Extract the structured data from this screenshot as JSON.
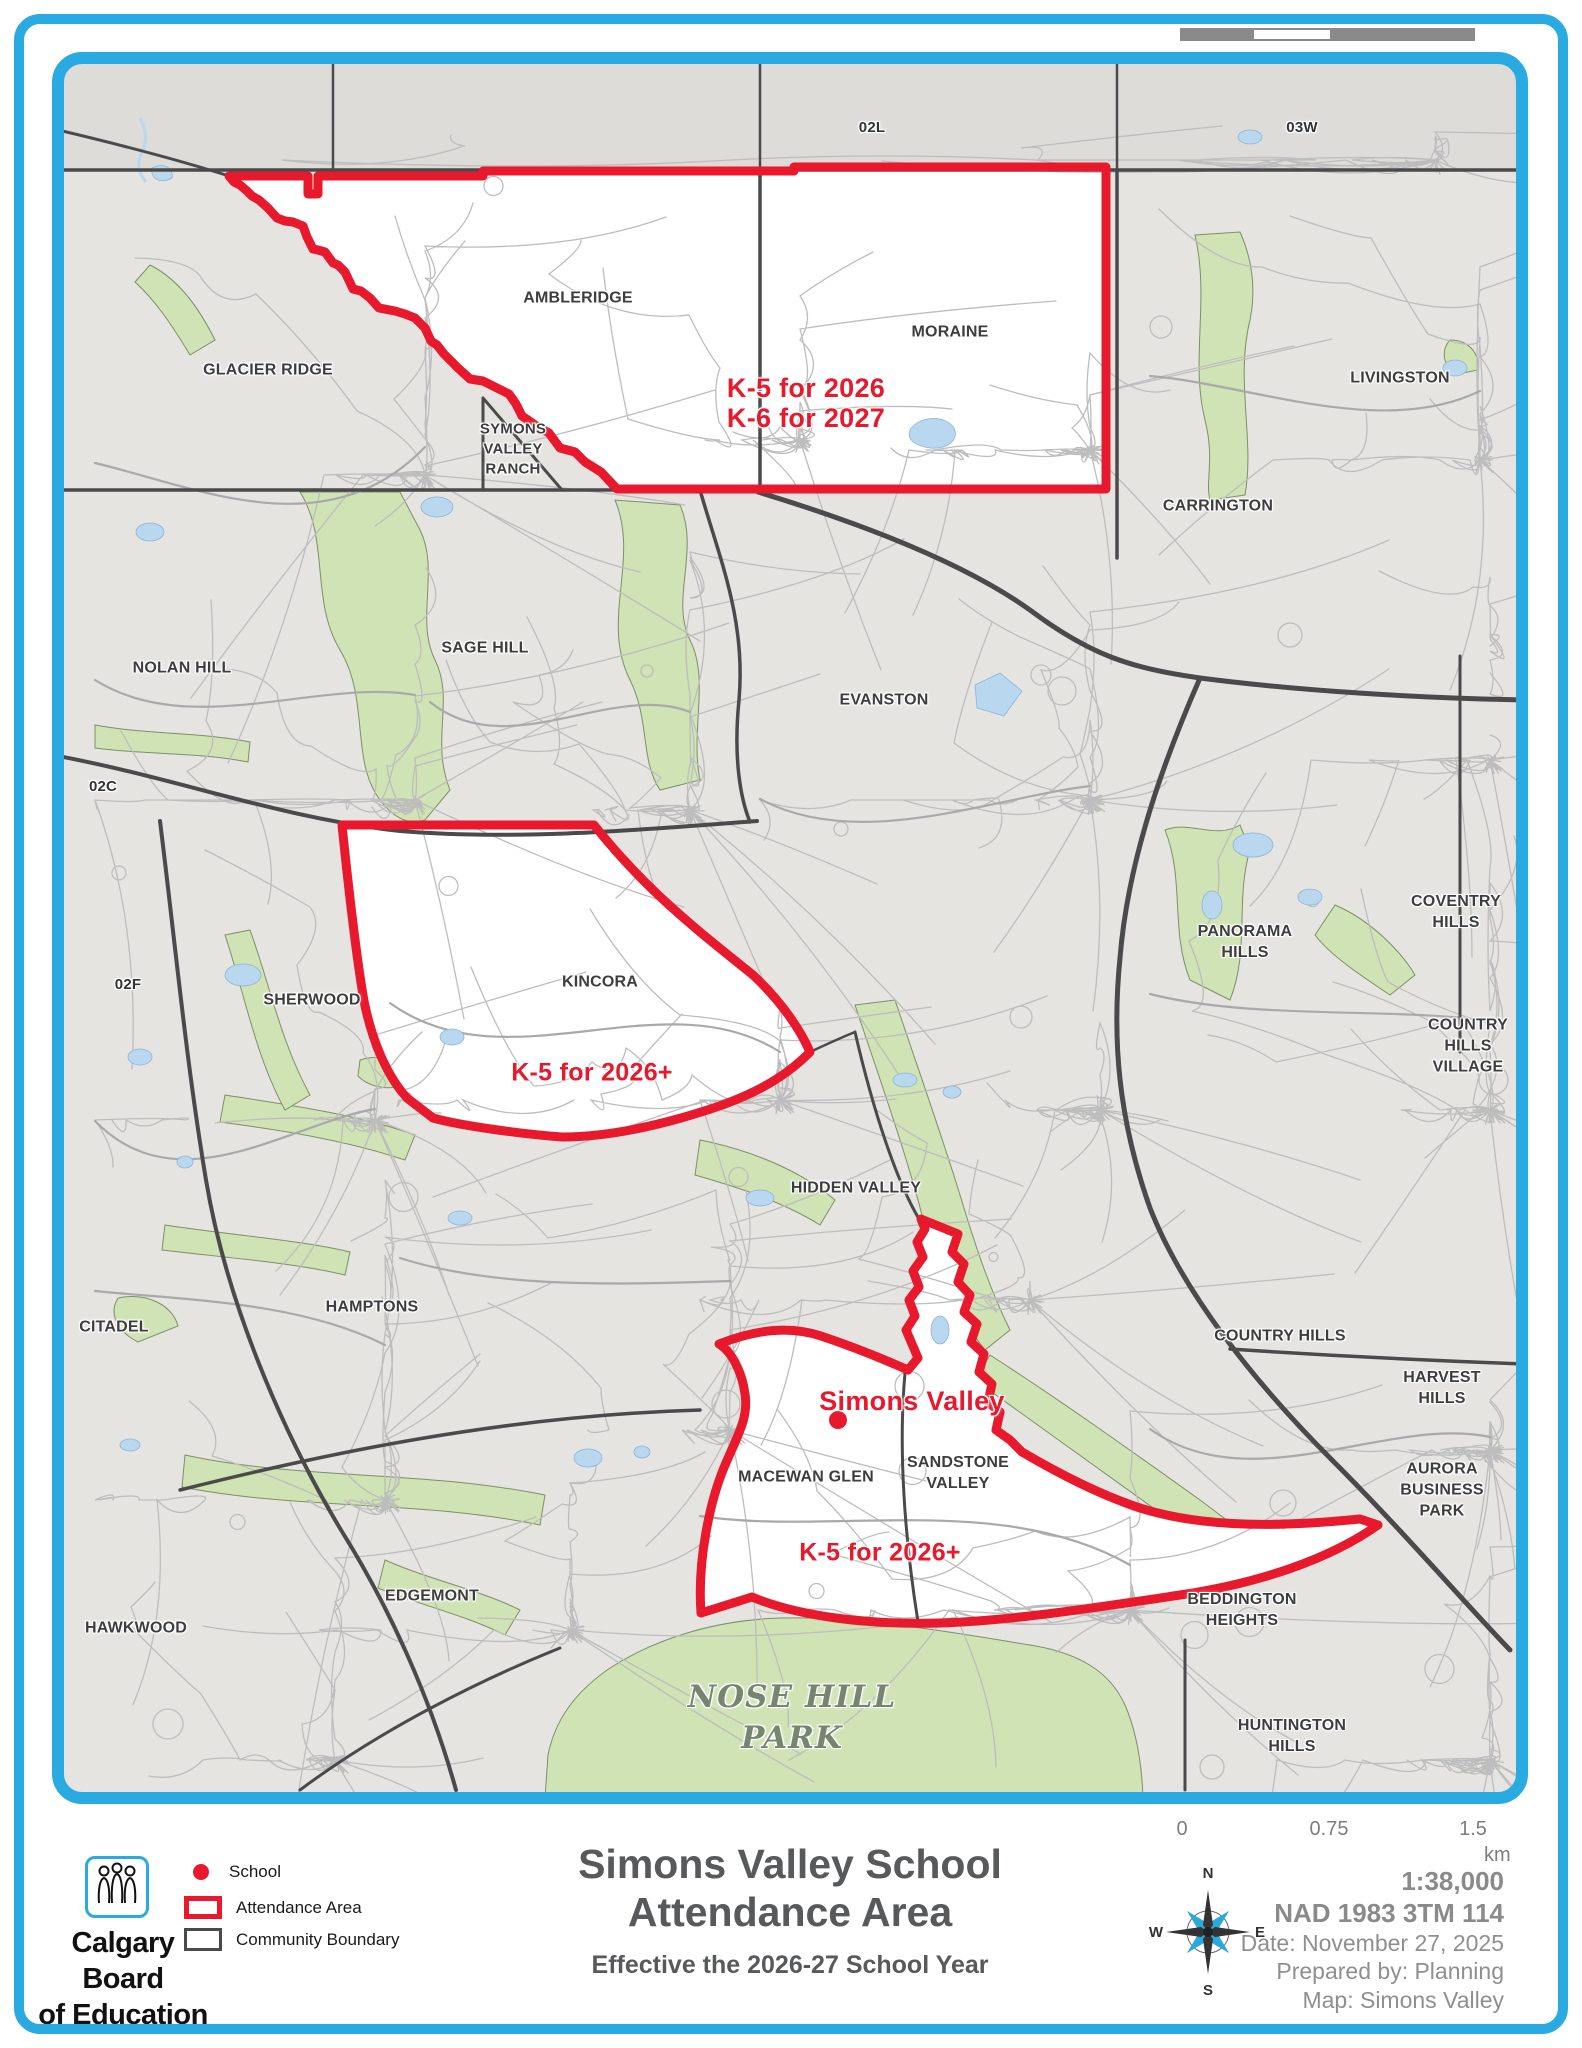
{
  "title": {
    "line1": "Simons Valley School",
    "line2": "Attendance Area",
    "subtitle": "Effective the 2026-27 School Year"
  },
  "brand": {
    "line1": "Calgary Board",
    "line2": "of Education"
  },
  "legend": {
    "school": "School",
    "attendance": "Attendance Area",
    "community": "Community Boundary"
  },
  "info": {
    "scale": "1:38,000",
    "datum": "NAD 1983 3TM 114",
    "date": "Date: November 27, 2025",
    "prepared": "Prepared by: Planning",
    "map": "Map: Simons Valley"
  },
  "scalebar": {
    "zero": "0",
    "mid": "0.75",
    "max": "1.5",
    "unit": "km"
  },
  "compass": {
    "n": "N",
    "e": "E",
    "s": "S",
    "w": "W"
  },
  "map": {
    "roads": {
      "l02l": "02L",
      "l03w": "03W",
      "l02c": "02C",
      "l02f": "02F"
    },
    "communities": {
      "glacier_ridge": "GLACIER RIDGE",
      "ambleridge": "AMBLERIDGE",
      "moraine": "MORAINE",
      "livingston": "LIVINGSTON",
      "symons_valley_ranch": "SYMONS\nVALLEY\nRANCH",
      "carrington": "CARRINGTON",
      "sage_hill": "SAGE HILL",
      "nolan_hill": "NOLAN HILL",
      "evanston": "EVANSTON",
      "sherwood": "SHERWOOD",
      "kincora": "KINCORA",
      "panorama_hills": "PANORAMA\nHILLS",
      "coventry_hills": "COVENTRY\nHILLS",
      "country_hills_village": "COUNTRY\nHILLS\nVILLAGE",
      "hidden_valley": "HIDDEN VALLEY",
      "hamptons": "HAMPTONS",
      "citadel": "CITADEL",
      "country_hills": "COUNTRY HILLS",
      "harvest_hills": "HARVEST\nHILLS",
      "aurora_business_park": "AURORA\nBUSINESS\nPARK",
      "macewan_glen": "MACEWAN GLEN",
      "sandstone_valley": "SANDSTONE\nVALLEY",
      "edgemont": "EDGEMONT",
      "hawkwood": "HAWKWOOD",
      "beddington_heights": "BEDDINGTON\nHEIGHTS",
      "huntington_hills": "HUNTINGTON\nHILLS",
      "nose_hill_park": "NOSE HILL\nPARK"
    },
    "annotations": {
      "k5_2026": "K-5 for 2026",
      "k6_2027": "K-6 for 2027",
      "kincora_k5": "K-5 for 2026+",
      "south_k5": "K-5 for 2026+",
      "school_name": "Simons Valley"
    }
  },
  "colors": {
    "frame_blue": "#29abe2",
    "attendance_red": "#e8192c",
    "park_green": "#cfe3b4",
    "water_blue": "#b9d7ee"
  }
}
